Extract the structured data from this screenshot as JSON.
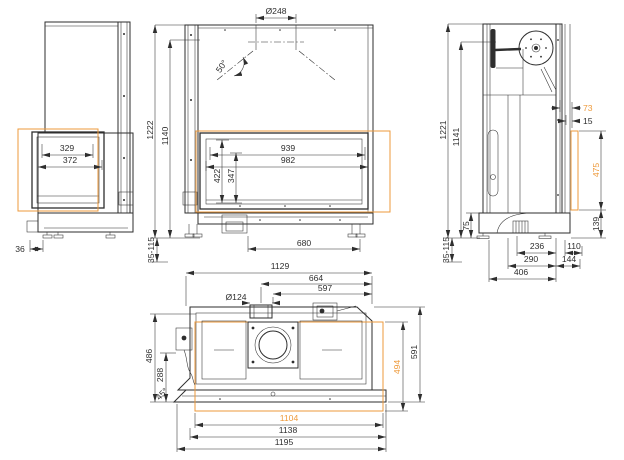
{
  "drawing_type": "fireplace-insert-dimension-drawing",
  "colors": {
    "accent": "#EE9A3B",
    "line": "#2e2e2e"
  },
  "dims": {
    "v1": {
      "glass_inner": "329",
      "glass_outer": "372",
      "front_offset": "36"
    },
    "v2": {
      "flue_diameter": "Ø248",
      "hood_angle": "50°",
      "total_height": "1222",
      "body_height": "1140",
      "glass_inner_w": "939",
      "glass_outer_w": "982",
      "glass_outer_h": "422",
      "glass_inner_h": "347",
      "feet_span": "680",
      "foot_range": "35-115"
    },
    "v3": {
      "total_height": "1221",
      "body_height": "1141",
      "glass_inset": "73",
      "pane_offset": "15",
      "glass_height": "475",
      "bottom_offset": "139",
      "base_height": "75",
      "duct_back": "236",
      "front_ext": "110",
      "duct_mid": "290",
      "front_depth": "144",
      "base_depth": "406",
      "foot_range": "35-115"
    },
    "v4": {
      "top_width": "1129",
      "flue_center": "664",
      "flue_edge": "597",
      "intake_diameter": "Ø124",
      "body_depth": "486",
      "inner_depth": "288",
      "corner_angle": "45°",
      "glass_depth": "494",
      "total_depth": "591",
      "glass_width": "1104",
      "mid_width": "1138",
      "total_width": "1195"
    }
  }
}
